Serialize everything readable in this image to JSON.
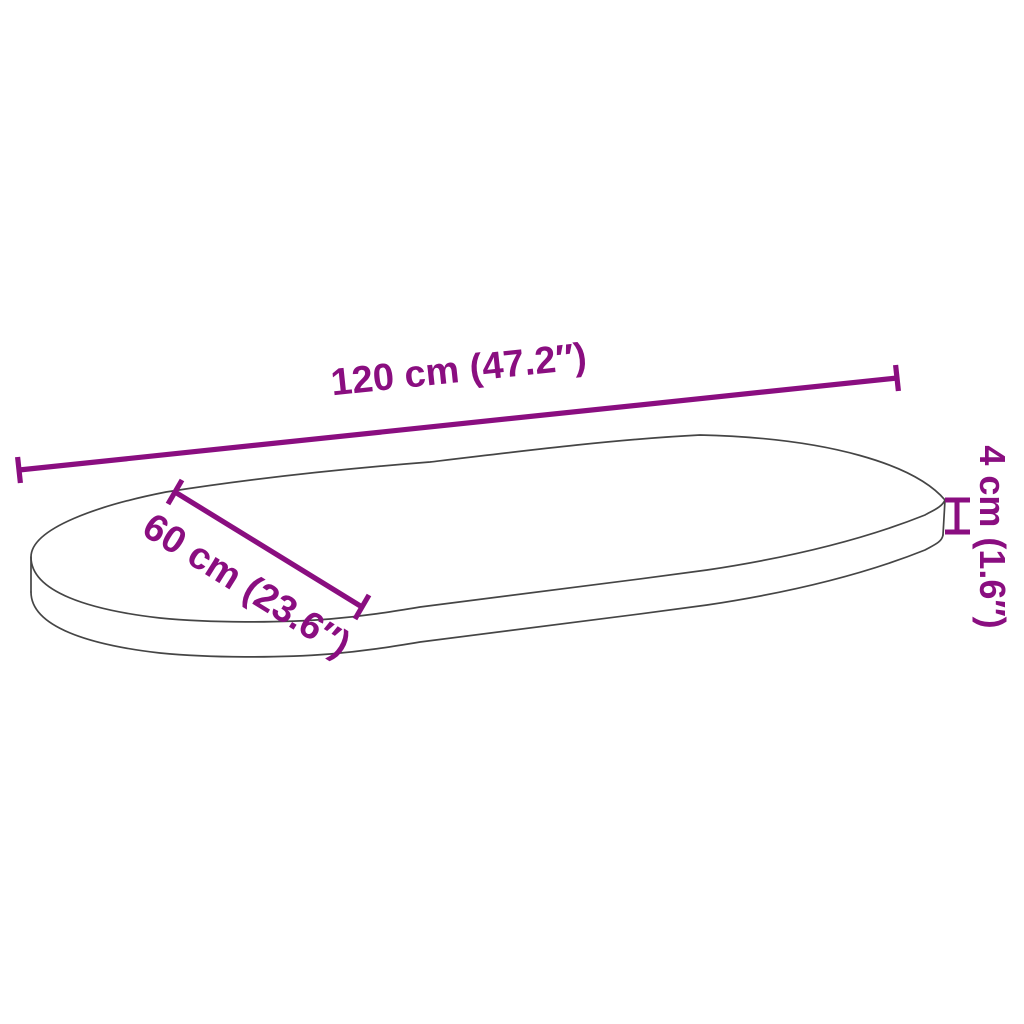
{
  "colors": {
    "dimension": "#8A0E80",
    "outline": "#454545",
    "background": "#FFFFFF"
  },
  "dimensions": {
    "length": {
      "label": "120 cm (47.2″)"
    },
    "width": {
      "label": "60 cm (23.6″)"
    },
    "thickness": {
      "label": "4 cm (1.6″)"
    }
  }
}
